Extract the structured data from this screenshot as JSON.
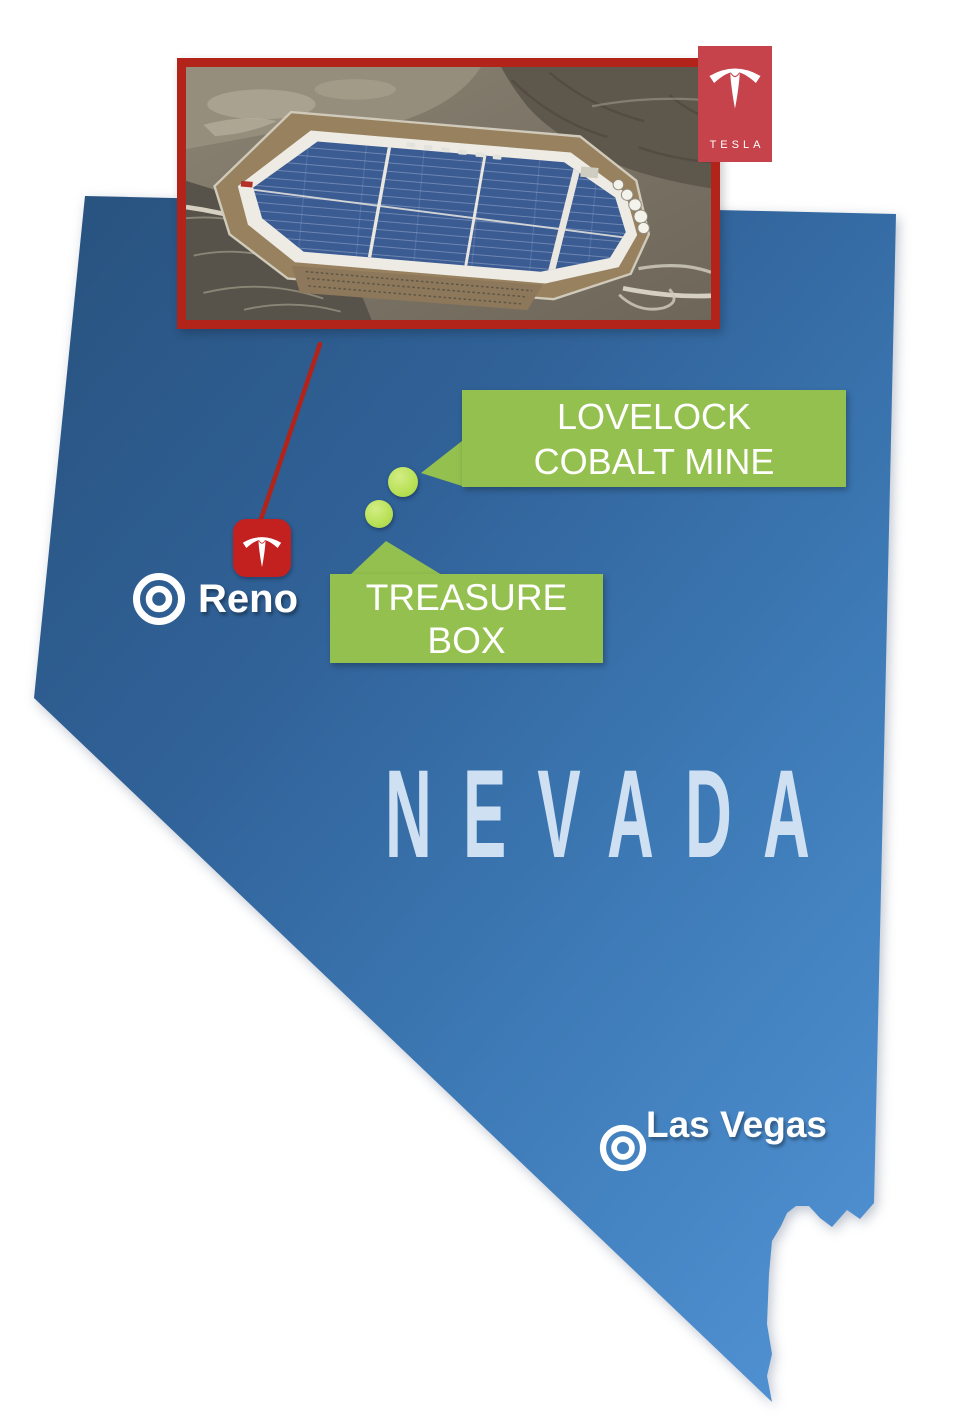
{
  "state": {
    "name": "NEVADA"
  },
  "badge": {
    "wordmark": "TESLA"
  },
  "markers": {
    "reno": {
      "label": "Reno"
    },
    "las_vegas": {
      "label": "Las Vegas"
    }
  },
  "callouts": {
    "lovelock": {
      "line1": "LOVELOCK",
      "line2": "COBALT MINE"
    },
    "treasure": {
      "line1": "TREASURE",
      "line2": "BOX"
    }
  },
  "icons": {
    "factory_pin": "tesla-logo-icon",
    "city_marker": "bullseye-icon",
    "mine_marker": "location-dot-icon",
    "inset_subject": "gigafactory-aerial-photo"
  },
  "colors": {
    "state_gradient_top": "#28527e",
    "state_gradient_bottom": "#4f90d1",
    "state_label": "#cfe0f2",
    "callout_green": "#94c04f",
    "dot_green": "#b8e055",
    "border_red": "#b2231a",
    "pin_red": "#c32120",
    "badge_red": "#c7434b",
    "text_white": "#ffffff"
  }
}
